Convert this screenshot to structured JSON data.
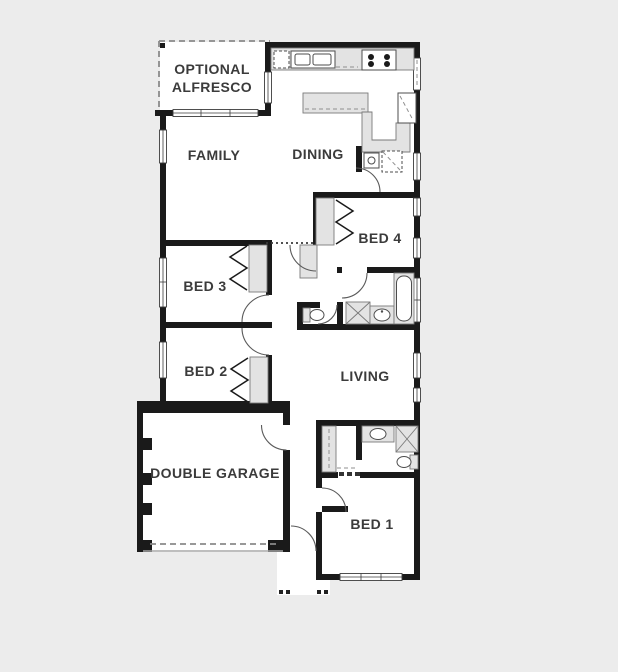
{
  "palette": {
    "background": "#ececec",
    "floor": "#ffffff",
    "wall": "#1a1a1a",
    "fixture_fill": "#e3e3e3",
    "label_text": "#3b3b3b"
  },
  "floor_plan": {
    "rooms": {
      "alfresco": {
        "label_line1": "OPTIONAL",
        "label_line2": "ALFRESCO"
      },
      "family": {
        "label": "FAMILY"
      },
      "dining": {
        "label": "DINING"
      },
      "bed4": {
        "label": "BED 4"
      },
      "bed3": {
        "label": "BED 3"
      },
      "bed2": {
        "label": "BED 2"
      },
      "living": {
        "label": "LIVING"
      },
      "garage": {
        "label": "DOUBLE GARAGE"
      },
      "bed1": {
        "label": "BED 1"
      }
    },
    "fixtures": [
      "kitchen-sink",
      "dishwasher",
      "cooktop",
      "island-bench",
      "kitchen-bench",
      "corner-pantry",
      "laundry-tub",
      "washing-machine",
      "linen-cupboard",
      "wardrobe-bed3",
      "wardrobe-bed2",
      "wardrobe-bed4",
      "bathtub",
      "shower",
      "vanity-basin",
      "toilet",
      "walk-in-robe",
      "ensuite-shower",
      "ensuite-basin",
      "ensuite-toilet",
      "garage-door",
      "porch-posts",
      "entry-door"
    ]
  }
}
